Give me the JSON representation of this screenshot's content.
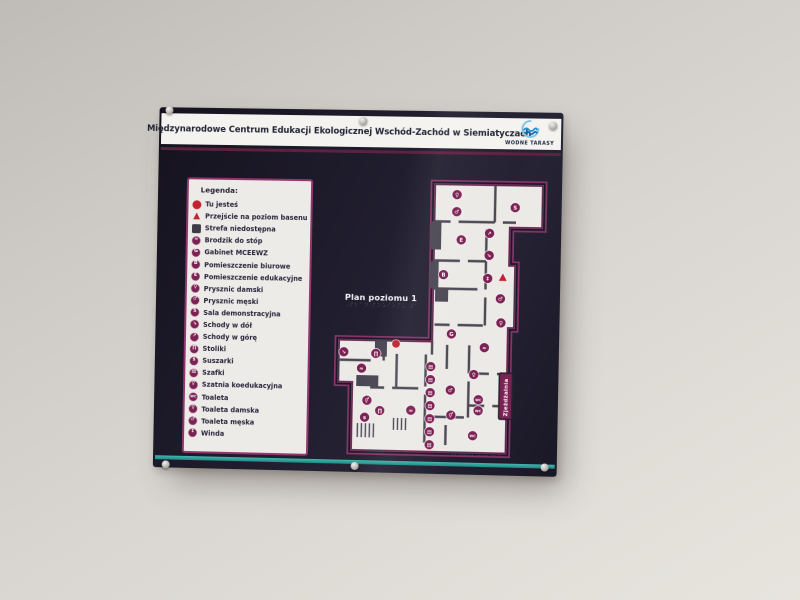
{
  "sign": {
    "title": "Międzynarodowe Centrum Edukacji Ekologicznej Wschód-Zachód w Siemiatyczach",
    "logo_text": "WODNE TARASY",
    "legend": {
      "header": "Legenda:",
      "items": [
        {
          "kind": "dot",
          "glyph": "",
          "icon": "you-are-here-icon",
          "label": "Tu jesteś"
        },
        {
          "kind": "triangle",
          "glyph": "▲",
          "icon": "pool-passage-icon",
          "label": "Przejście na poziom basenu"
        },
        {
          "kind": "square",
          "glyph": "",
          "icon": "restricted-zone-icon",
          "label": "Strefa niedostępna"
        },
        {
          "kind": "circle",
          "glyph": "≈",
          "icon": "foot-bath-icon",
          "label": "Brodzik do stóp"
        },
        {
          "kind": "circle",
          "glyph": "G",
          "icon": "office-mceewz-icon",
          "label": "Gabinet MCEEWZ"
        },
        {
          "kind": "circle",
          "glyph": "B",
          "icon": "office-room-icon",
          "label": "Pomieszczenie biurowe"
        },
        {
          "kind": "circle",
          "glyph": "E",
          "icon": "education-room-icon",
          "label": "Pomieszczenie edukacyjne"
        },
        {
          "kind": "circle",
          "glyph": "♀",
          "icon": "shower-women-icon",
          "label": "Prysznic damski"
        },
        {
          "kind": "circle",
          "glyph": "♂",
          "icon": "shower-men-icon",
          "label": "Prysznic męski"
        },
        {
          "kind": "circle",
          "glyph": "S",
          "icon": "demo-room-icon",
          "label": "Sala demonstracyjna"
        },
        {
          "kind": "circle",
          "glyph": "↘",
          "icon": "stairs-down-icon",
          "label": "Schody w dół"
        },
        {
          "kind": "circle",
          "glyph": "↗",
          "icon": "stairs-up-icon",
          "label": "Schody w górę"
        },
        {
          "kind": "circle",
          "glyph": "∏",
          "icon": "tables-icon",
          "label": "Stoliki"
        },
        {
          "kind": "circle",
          "glyph": "s",
          "icon": "dryers-icon",
          "label": "Suszarki"
        },
        {
          "kind": "circle",
          "glyph": "▤",
          "icon": "lockers-icon",
          "label": "Szafki"
        },
        {
          "kind": "circle",
          "glyph": "⚥",
          "icon": "changing-room-icon",
          "label": "Szatnia koedukacyjna"
        },
        {
          "kind": "circle",
          "glyph": "WC",
          "icon": "toilet-icon",
          "label": "Toaleta"
        },
        {
          "kind": "circle",
          "glyph": "♀",
          "icon": "toilet-women-icon",
          "label": "Toaleta damska"
        },
        {
          "kind": "circle",
          "glyph": "♂",
          "icon": "toilet-men-icon",
          "label": "Toaleta męska"
        },
        {
          "kind": "circle",
          "glyph": "↕",
          "icon": "elevator-icon",
          "label": "Winda"
        }
      ]
    },
    "plan": {
      "label": "Plan poziomu 1",
      "braille": "⠠⠏⠇⠁⠝ ⠏⠕⠵⠊⠕⠍⠥ ⠼⠁",
      "slide_label": "Zjeżdżalnia",
      "footer_print": "·· ······ ····· ·· ·",
      "icons": [
        {
          "x": 125,
          "y": 18,
          "g": "♀",
          "k": "c"
        },
        {
          "x": 125,
          "y": 35,
          "g": "♂",
          "k": "c"
        },
        {
          "x": 183,
          "y": 30,
          "g": "S",
          "k": "c"
        },
        {
          "x": 158,
          "y": 56,
          "g": "↗",
          "k": "c"
        },
        {
          "x": 130,
          "y": 63,
          "g": "E",
          "k": "c"
        },
        {
          "x": 158,
          "y": 78,
          "g": "↘",
          "k": "c"
        },
        {
          "x": 113,
          "y": 98,
          "g": "B",
          "k": "c"
        },
        {
          "x": 157,
          "y": 101,
          "g": "↕",
          "k": "c"
        },
        {
          "x": 172,
          "y": 100,
          "g": "",
          "k": "t"
        },
        {
          "x": 170,
          "y": 121,
          "g": "♂",
          "k": "c"
        },
        {
          "x": 171,
          "y": 145,
          "g": "♀",
          "k": "c"
        },
        {
          "x": 122,
          "y": 157,
          "g": "G",
          "k": "c"
        },
        {
          "x": 155,
          "y": 170,
          "g": "≈",
          "k": "c"
        },
        {
          "x": 67,
          "y": 168,
          "g": "",
          "k": "d"
        },
        {
          "x": 15,
          "y": 177,
          "g": "↘",
          "k": "c"
        },
        {
          "x": 47,
          "y": 178,
          "g": "∏",
          "k": "c"
        },
        {
          "x": 33,
          "y": 193,
          "g": "≈",
          "k": "c"
        },
        {
          "x": 102,
          "y": 190,
          "g": "▤",
          "k": "c"
        },
        {
          "x": 102,
          "y": 203,
          "g": "▤",
          "k": "c"
        },
        {
          "x": 102,
          "y": 216,
          "g": "▤",
          "k": "c"
        },
        {
          "x": 102,
          "y": 229,
          "g": "▤",
          "k": "c"
        },
        {
          "x": 102,
          "y": 242,
          "g": "▤",
          "k": "c"
        },
        {
          "x": 102,
          "y": 255,
          "g": "▤",
          "k": "c"
        },
        {
          "x": 102,
          "y": 268,
          "g": "▤",
          "k": "c"
        },
        {
          "x": 145,
          "y": 197,
          "g": "♀",
          "k": "c"
        },
        {
          "x": 122,
          "y": 213,
          "g": "♂",
          "k": "c"
        },
        {
          "x": 150,
          "y": 222,
          "g": "WC",
          "k": "c"
        },
        {
          "x": 150,
          "y": 233,
          "g": "WC",
          "k": "c"
        },
        {
          "x": 123,
          "y": 238,
          "g": "⚥",
          "k": "c"
        },
        {
          "x": 39,
          "y": 225,
          "g": "⚥",
          "k": "c"
        },
        {
          "x": 52,
          "y": 235,
          "g": "∏",
          "k": "c"
        },
        {
          "x": 37,
          "y": 242,
          "g": "s",
          "k": "c"
        },
        {
          "x": 83,
          "y": 234,
          "g": "≈",
          "k": "c"
        },
        {
          "x": 145,
          "y": 258,
          "g": "WC",
          "k": "c"
        }
      ]
    }
  }
}
